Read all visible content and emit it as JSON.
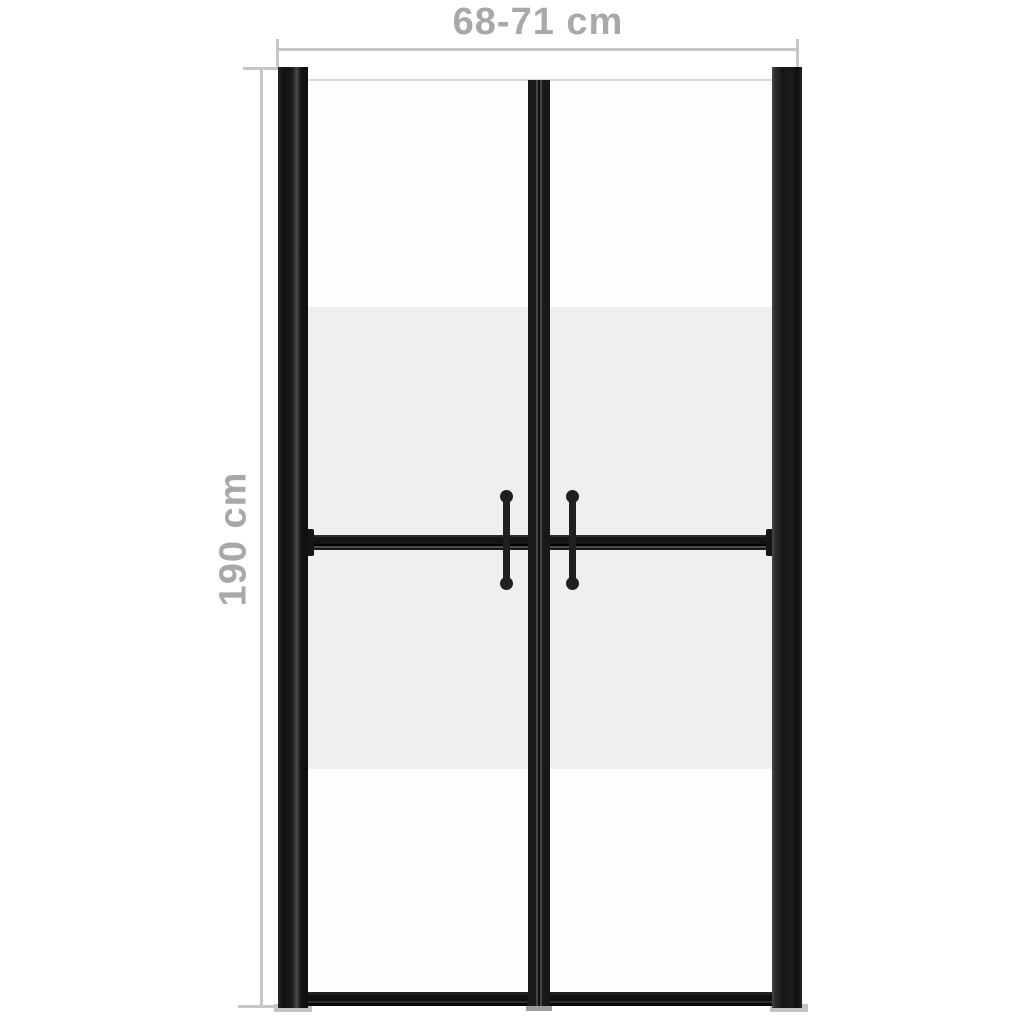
{
  "diagram": {
    "subject": "double shower door with half-frosted glass",
    "dimensions": {
      "width": {
        "label": "68-71 cm"
      },
      "height": {
        "label": "190 cm"
      }
    },
    "door": {
      "panel_count": 2,
      "handle_count": 2,
      "glass_bands_top_to_bottom": [
        "clear",
        "frosted",
        "frosted",
        "clear"
      ]
    },
    "colors": {
      "frame_black": "#1a1a1a",
      "frame_highlight": "#4a4a4a",
      "glass_clear": "#fdfdfd",
      "glass_frosted": "#efefef",
      "dimension_line_gray": "#c6c6c6",
      "dimension_text_gray": "#a8a8a8",
      "foot_gray": "#c3c3c3",
      "background": "#ffffff"
    }
  }
}
